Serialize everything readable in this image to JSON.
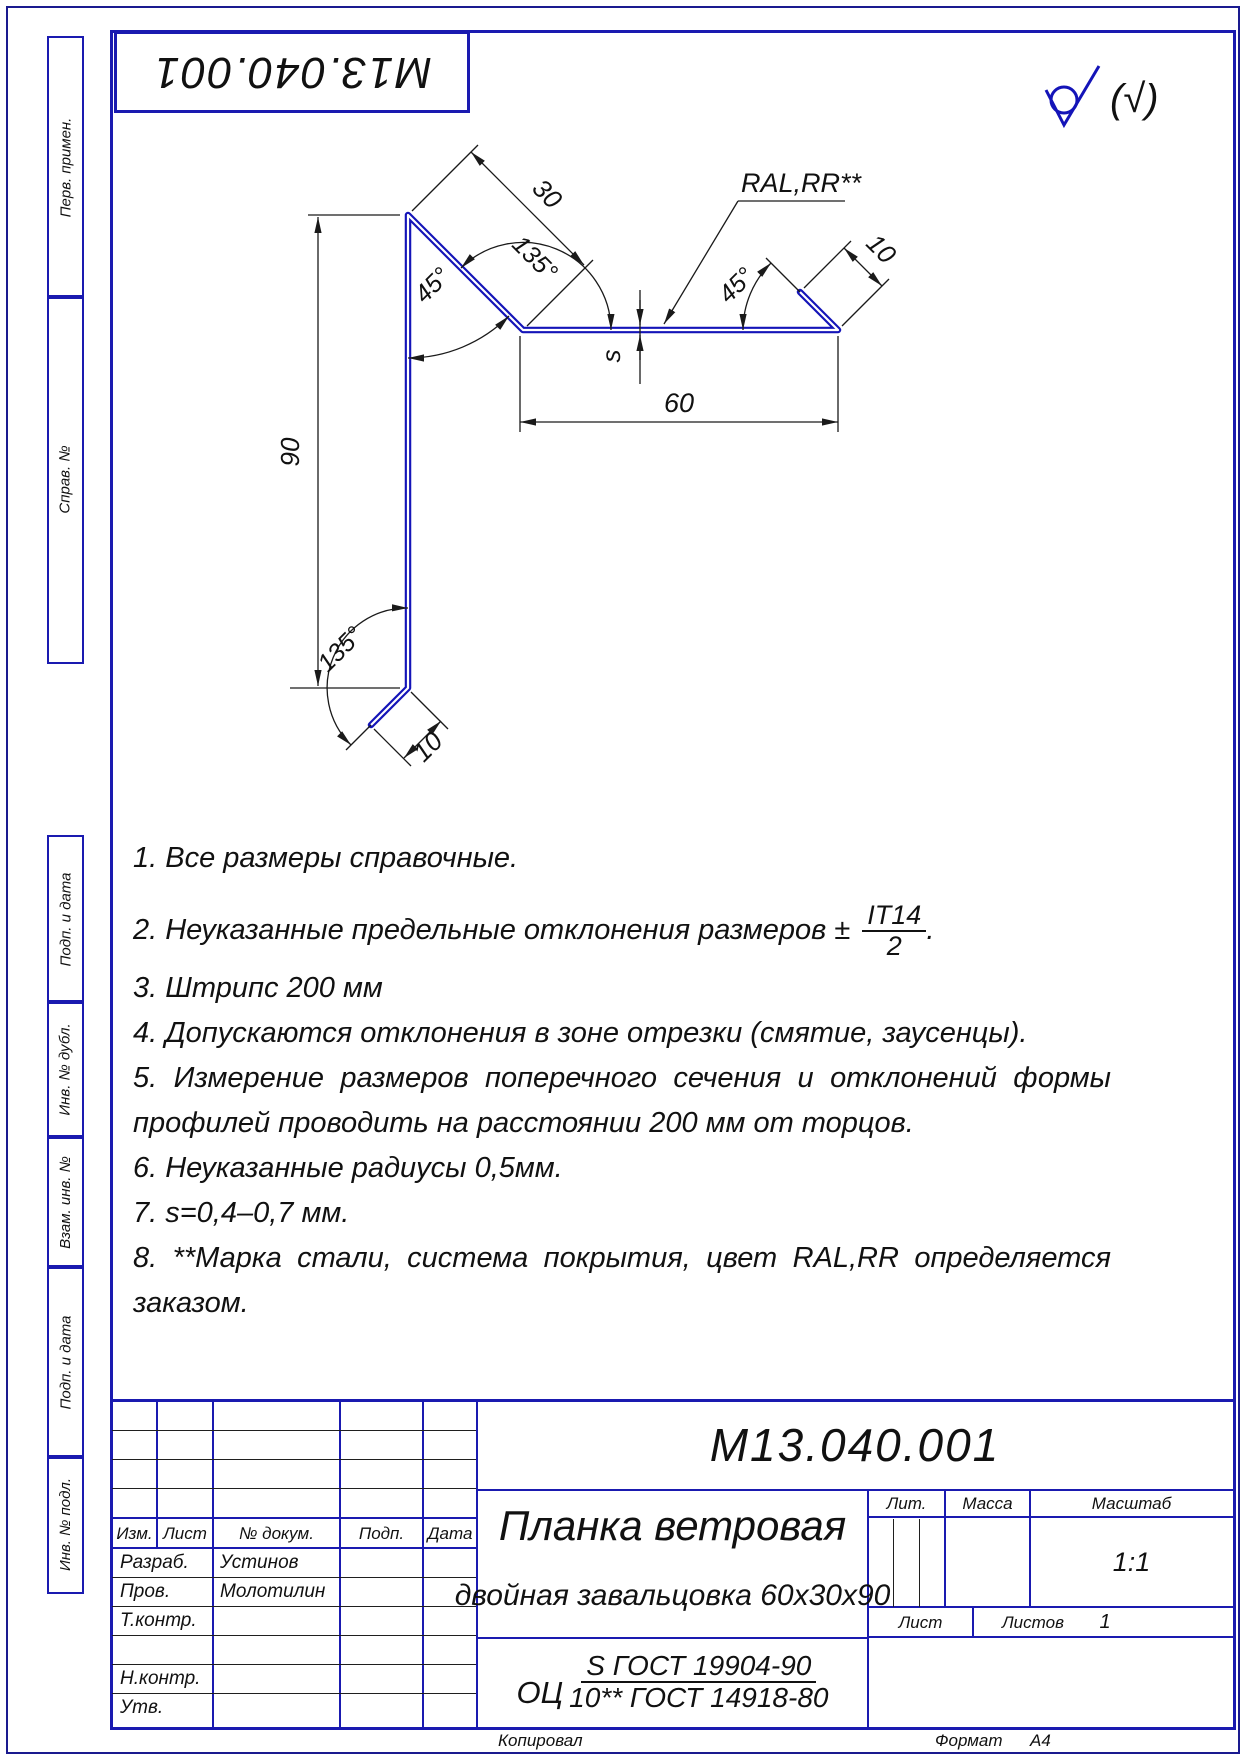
{
  "page": {
    "stamp_top": "М13.040.001",
    "footer": {
      "copied": "Копировал",
      "format_label": "Формат",
      "format_value": "А4"
    }
  },
  "margin": {
    "perv_primen": "Перв. примен.",
    "sprav_no": "Справ. №",
    "podp_data1": "Подп. и дата",
    "inv_dubl": "Инв. № дубл.",
    "vzam_inv": "Взам. инв. №",
    "podp_data2": "Подп. и дата",
    "inv_podl": "Инв. № подл."
  },
  "drawing": {
    "roughness_note": "(√)",
    "dims": {
      "height": "90",
      "flange_top": "30",
      "angle_top": "135°",
      "angle_top_left": "45°",
      "thickness": "s",
      "width": "60",
      "angle_right": "45°",
      "hem_right": "10",
      "angle_bottom": "135°",
      "hem_bottom": "10",
      "coating_label": "RAL,RR**"
    }
  },
  "notes": {
    "fraction": {
      "num": "IT14",
      "den": "2",
      "tail": "."
    },
    "lines": [
      {
        "text": "1.  Все размеры справочные."
      },
      {
        "text": "2.  Неуказанные предельные отклонения размеров ±",
        "frac": true
      },
      {
        "text": "3.  Штрипс 200 мм"
      },
      {
        "text": "4.  Допускаются отклонения в зоне отрезки (смятие, заусенцы)."
      },
      {
        "text": "5.  Измерение размеров поперечного сечения и отклонений формы",
        "justify": true
      },
      {
        "text": "профилей проводить на расстоянии 200 мм от торцов."
      },
      {
        "text": "6.  Неуказанные радиусы 0,5мм."
      },
      {
        "text": "7.  s=0,4–0,7 мм."
      },
      {
        "text": "8.  **Марка стали, система покрытия, цвет RAL,RR определяется",
        "justify": true
      },
      {
        "text": "заказом."
      }
    ]
  },
  "titleblock": {
    "designation": "М13.040.001",
    "name_line1": "Планка ветровая",
    "name_line2": "двойная завальцовка 60х30х90",
    "material": {
      "prefix": "ОЦ",
      "num": "S ГОСТ 19904-90",
      "den": "10** ГОСТ 14918-80"
    },
    "headers": {
      "izm": "Изм.",
      "list": "Лист",
      "ndoc": "№ докум.",
      "podp": "Подп.",
      "data": "Дата",
      "lit": "Лит.",
      "massa": "Масса",
      "masshtab": "Масштаб",
      "list_small": "Лист",
      "listov": "Листов"
    },
    "scale": "1:1",
    "sheets_value": "1",
    "signature_rows": [
      {
        "role": "Разраб.",
        "name": "Устинов"
      },
      {
        "role": "Пров.",
        "name": "Молотилин"
      },
      {
        "role": "Т.контр.",
        "name": ""
      },
      {
        "role": "",
        "name": ""
      },
      {
        "role": "Н.контр.",
        "name": ""
      },
      {
        "role": "Утв.",
        "name": ""
      }
    ]
  }
}
